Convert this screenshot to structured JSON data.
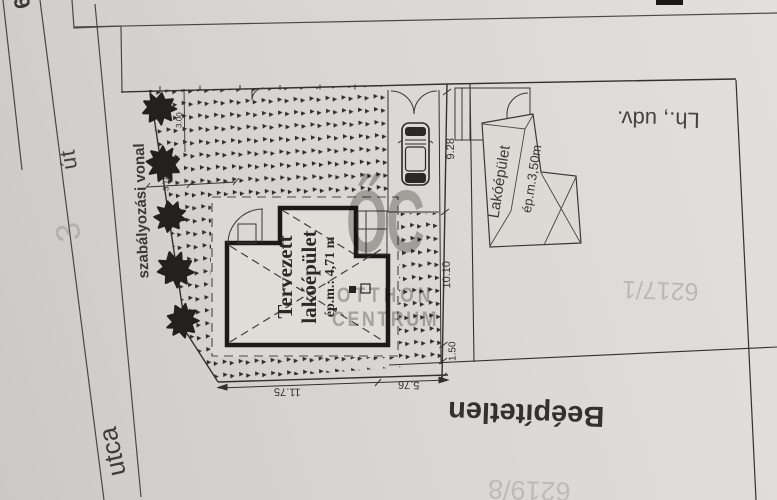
{
  "plan": {
    "street_number_top": "6",
    "road_label": "út",
    "street_label": "utca",
    "faint_street_number": "3",
    "regulation_line_label": "szabályozási vonal",
    "main_building": {
      "line1": "Tervezett",
      "line2": "lakóépület",
      "height": "ép.m.: 4,71 m"
    },
    "neighbor_building": {
      "name": "Lakóépület",
      "height": "ép.m.3,50m"
    },
    "yard_label": "Lh., udv.",
    "undeveloped_label": "Beépítetlen",
    "parcel_number_right": "6217/1",
    "parcel_number_bottom": "6219/8",
    "dimensions": {
      "front_left": "11.75",
      "front_right": "5.76",
      "side_top": "9.28",
      "side_middle": "10.10",
      "side_lower": "1.50",
      "tree_spacing_a": "3.00",
      "tree_spacing_b": "3.18"
    }
  },
  "watermark": {
    "logo": "ŐC",
    "name_line1": "OTTHON",
    "name_line2": "CENTRUM"
  },
  "colors": {
    "paper": "#d8d6d2",
    "ink_thin": "#3a3835",
    "ink_thick": "#1b1a18",
    "pattern_mark": "#2f2d2a",
    "watermark_gray": "#9e9c98"
  }
}
